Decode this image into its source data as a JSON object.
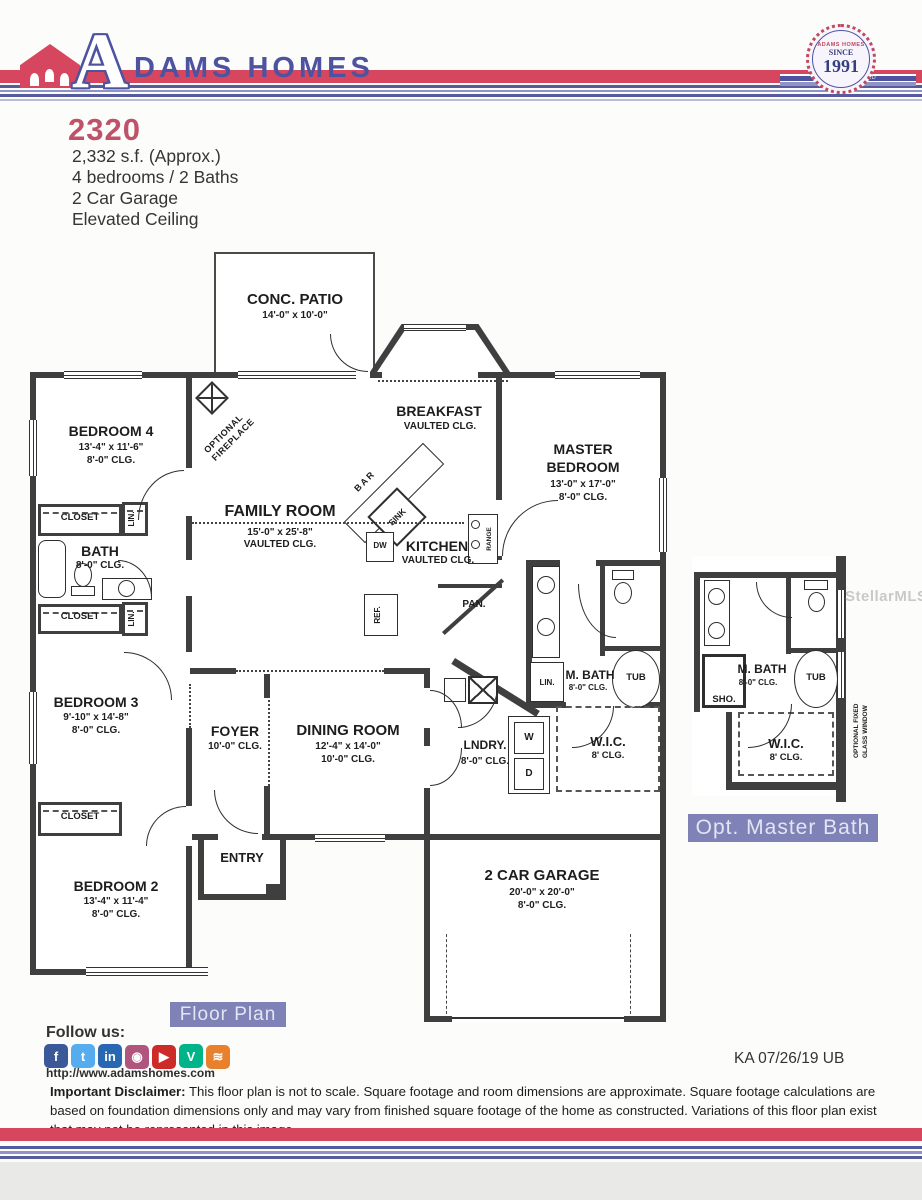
{
  "header": {
    "brand_initial": "A",
    "brand_rest": "DAMS HOMES",
    "seal": {
      "arc": "ADAMS HOMES",
      "since": "SINCE",
      "year": "1991",
      "ribbon": "VALUE SWIFT FID"
    }
  },
  "info": {
    "model": "2320",
    "sqft": "2,332 s.f. (Approx.)",
    "beds": "4 bedrooms / 2 Baths",
    "garage": "2 Car Garage",
    "ceiling": "Elevated Ceiling"
  },
  "plan": {
    "patio": {
      "name": "CONC. PATIO",
      "dims": "14'-0\" x 10'-0\""
    },
    "breakfast": {
      "name": "BREAKFAST",
      "clg": "VAULTED CLG."
    },
    "family": {
      "name": "FAMILY ROOM",
      "dims": "15'-0\" x 25'-8\"",
      "clg": "VAULTED CLG."
    },
    "kitchen": {
      "name": "KITCHEN",
      "clg": "VAULTED CLG."
    },
    "master": {
      "name": "MASTER\nBEDROOM",
      "dims": "13'-0\" x 17'-0\"",
      "clg": "8'-0\" CLG."
    },
    "bedroom4": {
      "name": "BEDROOM 4",
      "dims": "13'-4\" x 11'-6\"",
      "clg": "8'-0\" CLG."
    },
    "bath": {
      "name": "BATH",
      "clg": "8'-0\" CLG."
    },
    "bedroom3": {
      "name": "BEDROOM 3",
      "dims": "9'-10\" x 14'-8\"",
      "clg": "8'-0\" CLG."
    },
    "bedroom2": {
      "name": "BEDROOM 2",
      "dims": "13'-4\" x 11'-4\"",
      "clg": "8'-0\" CLG."
    },
    "foyer": {
      "name": "FOYER",
      "clg": "10'-0\" CLG."
    },
    "dining": {
      "name": "DINING ROOM",
      "dims": "12'-4\" x 14'-0\"",
      "clg": "10'-0\" CLG."
    },
    "laundry": {
      "name": "LNDRY.",
      "clg": "8'-0\" CLG."
    },
    "mbath": {
      "name": "M. BATH",
      "clg": "8'-0\" CLG."
    },
    "wic": {
      "name": "W.I.C.",
      "clg": "8' CLG."
    },
    "entry": {
      "name": "ENTRY"
    },
    "garage": {
      "name": "2 CAR GARAGE",
      "dims": "20'-0\" x 20'-0\"",
      "clg": "8'-0\" CLG."
    },
    "closet": "CLOSET",
    "linen": "LIN.",
    "bar": "BAR",
    "sink": "SINK",
    "dw": "DW",
    "range": "RANGE",
    "ref": "REF.",
    "pantry": "PAN.",
    "tub": "TUB",
    "washer": "W",
    "dryer": "D",
    "optional_fireplace": "OPTIONAL\nFIREPLACE",
    "opt_detail": {
      "mbath": "M. BATH",
      "mbath_clg": "8'-0\" CLG.",
      "wic": "W.I.C.",
      "wic_clg": "8' CLG.",
      "tub": "TUB",
      "shower": "SHO.",
      "window_note": "OPTIONAL FIXED\nGLASS WINDOW",
      "label": "Opt. Master Bath"
    }
  },
  "footer": {
    "floor_plan_label": "Floor Plan",
    "follow_us": "Follow us:",
    "website": "http://www.adamshomes.com",
    "revision": "KA 07/26/19 UB",
    "disclaimer_title": "Important Disclaimer:",
    "disclaimer_text": " This floor plan is not to scale. Square footage and room dimensions are approximate. Square footage calculations are based on foundation dimensions only and may vary from finished square footage of the home as constructed. Variations of this floor plan exist that may not be represented in this image.",
    "social": [
      {
        "name": "facebook",
        "glyph": "f",
        "color": "#3b5998"
      },
      {
        "name": "twitter",
        "glyph": "t",
        "color": "#55acee"
      },
      {
        "name": "linkedin",
        "glyph": "in",
        "color": "#2867b2"
      },
      {
        "name": "instagram",
        "glyph": "◉",
        "color": "#b0567e"
      },
      {
        "name": "youtube",
        "glyph": "▶",
        "color": "#cc2b27"
      },
      {
        "name": "vine",
        "glyph": "V",
        "color": "#00b489"
      },
      {
        "name": "rss",
        "glyph": "≋",
        "color": "#e8802e"
      }
    ]
  },
  "watermark": "StellarMLS",
  "colors": {
    "brand_red": "#d6465f",
    "brand_blue": "#4e53a0",
    "chip_bg": "#7e82b6",
    "wall": "#3f3f3f"
  }
}
